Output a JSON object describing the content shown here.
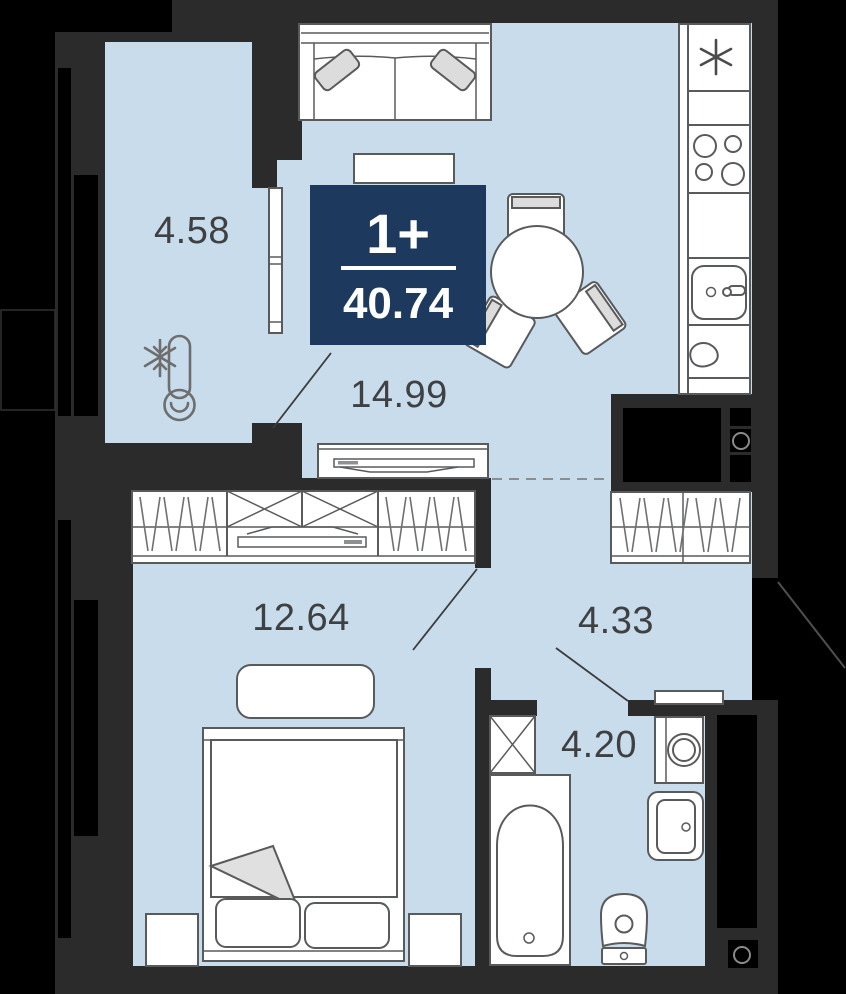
{
  "apartment": {
    "type_badge": "1+",
    "total_area": "40.74"
  },
  "rooms": [
    {
      "id": "balcony",
      "area": "4.58"
    },
    {
      "id": "living_kitchen",
      "area": "14.99"
    },
    {
      "id": "bedroom",
      "area": "12.64"
    },
    {
      "id": "hallway",
      "area": "4.33"
    },
    {
      "id": "bathroom",
      "area": "4.20"
    }
  ],
  "colors": {
    "floor": "#c8dcec",
    "wall": "#2b2b2b",
    "outside": "#000000",
    "badge_bg": "#1d3a5e",
    "badge_text": "#ffffff",
    "furniture_stroke": "#585a5c",
    "label_text": "#3f4042"
  }
}
